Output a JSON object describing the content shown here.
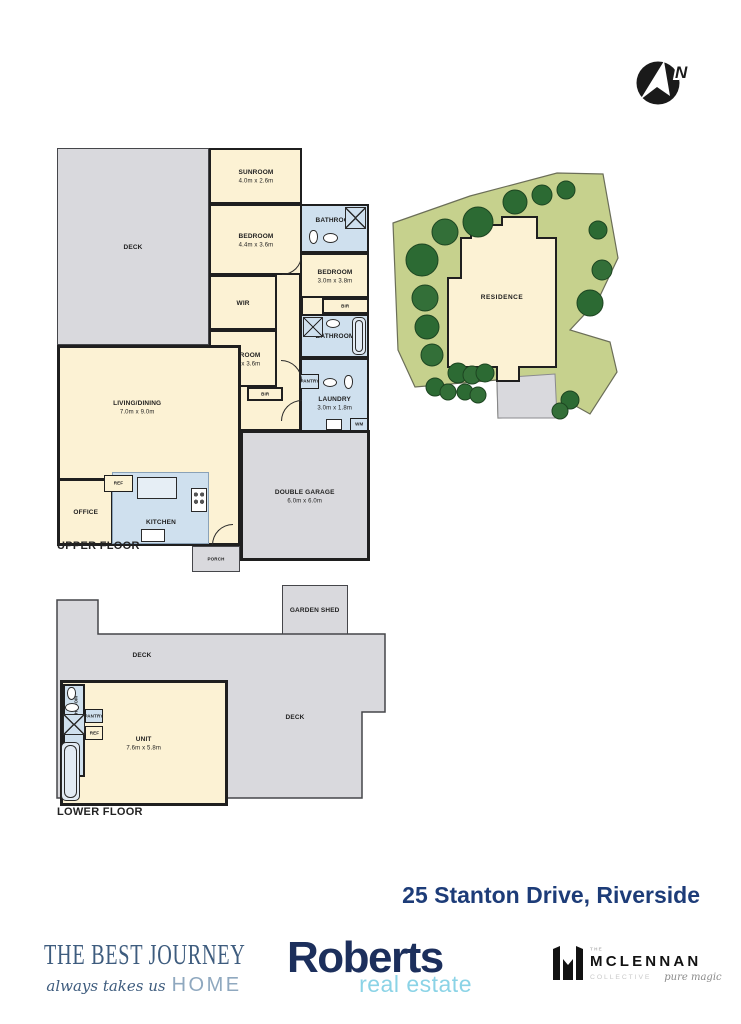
{
  "compass": {
    "n": "N"
  },
  "upper": {
    "title": "UPPER FLOOR",
    "deck": {
      "name": "DECK"
    },
    "sunroom": {
      "name": "SUNROOM",
      "dims": "4.0m x 2.6m"
    },
    "bedroom1": {
      "name": "BEDROOM",
      "dims": "4.4m x 3.6m"
    },
    "bathroom1": {
      "name": "BATHROOM"
    },
    "bedroom2": {
      "name": "BEDROOM",
      "dims": "3.0m x 3.8m"
    },
    "wir": {
      "name": "WIR"
    },
    "bir1": {
      "name": "BIR"
    },
    "bathroom2": {
      "name": "BATHROOM"
    },
    "bedroom3": {
      "name": "BEDROOM",
      "dims": "3.2m x 3.6m"
    },
    "bir2": {
      "name": "BIR"
    },
    "pantry": {
      "name": "PANTRY"
    },
    "laundry": {
      "name": "LAUNDRY",
      "dims": "3.0m x 1.8m"
    },
    "wm": {
      "name": "WM"
    },
    "living": {
      "name": "LIVING/DINING",
      "dims": "7.0m x 9.0m"
    },
    "office": {
      "name": "OFFICE"
    },
    "ref": {
      "name": "REF"
    },
    "kitchen": {
      "name": "KITCHEN"
    },
    "garage": {
      "name": "DOUBLE GARAGE",
      "dims": "6.0m x 6.0m"
    },
    "porch": {
      "name": "PORCH"
    }
  },
  "site": {
    "residence": "RESIDENCE"
  },
  "lower": {
    "title": "LOWER FLOOR",
    "shed": {
      "name": "GARDEN SHED"
    },
    "deck1": {
      "name": "DECK"
    },
    "deck2": {
      "name": "DECK"
    },
    "unit": {
      "name": "UNIT",
      "dims": "7.6m x 5.8m"
    },
    "bathroom": {
      "name": "BATHROOM"
    },
    "pantry": {
      "name": "PANTRY"
    },
    "ref": {
      "name": "REF"
    }
  },
  "address": "25 Stanton Drive, Riverside",
  "branding": {
    "journey": {
      "title": "THE BEST JOURNEY",
      "script": "always takes us",
      "home": "HOME"
    },
    "roberts": {
      "name": "Roberts",
      "tagline": "real estate"
    },
    "mclennan": {
      "the": "THE",
      "name": "MCLENNAN",
      "collective": "COLLECTIVE",
      "script": "pure magic"
    }
  },
  "colors": {
    "room_cream": "#fcf2d4",
    "wet_blue": "#cfe0ee",
    "deck_gray": "#d9d9dd",
    "wall": "#1f1f1f",
    "site_green": "#c6d18d",
    "tree_green": "#2c6a33",
    "address_navy": "#1d3c78",
    "roberts_navy": "#1c2f5c",
    "roberts_cyan": "#8bd3e6",
    "journey_blue": "#3e5c7e",
    "journey_home": "#8fa8bf"
  }
}
